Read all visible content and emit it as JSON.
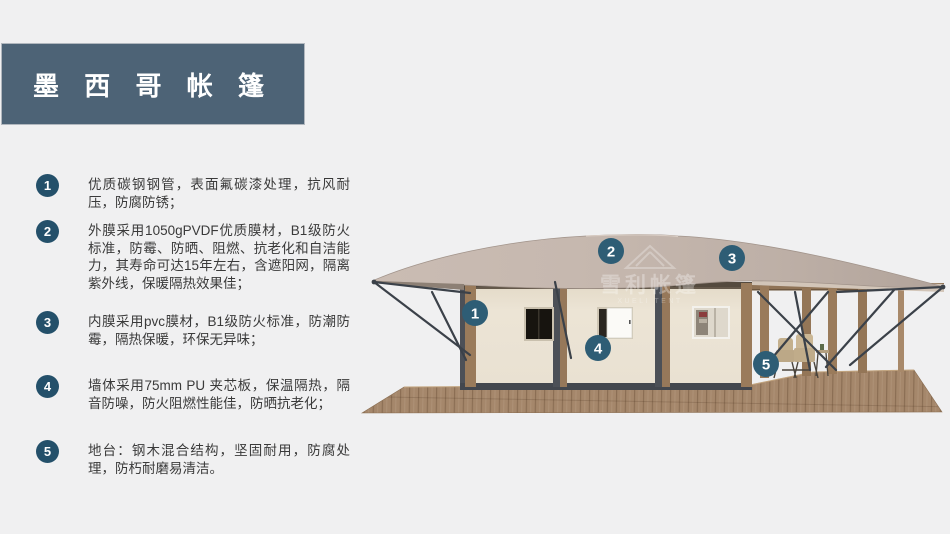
{
  "title": {
    "text": "墨 西 哥 帐 篷"
  },
  "features": [
    {
      "num": "1",
      "text": "优质碳钢钢管，表面氟碳漆处理，抗风耐压，防腐防锈；"
    },
    {
      "num": "2",
      "text": "外膜采用1050gPVDF优质膜材，B1级防火标准，防霉、防晒、阻燃、抗老化和自洁能力，其寿命可达15年左右，含遮阳网，隔离紫外线，保暖隔热效果佳；"
    },
    {
      "num": "3",
      "text": "内膜采用pvc膜材，B1级防火标准，防潮防霉，隔热保暖，环保无异味；"
    },
    {
      "num": "4",
      "text": "墙体采用75mm PU 夹芯板，保温隔热，隔音防噪，防火阻燃性能佳，防晒抗老化；"
    },
    {
      "num": "5",
      "text": "地台：钢木混合结构，坚固耐用，防腐处理，防朽耐磨易清洁。"
    }
  ],
  "tent": {
    "markers": [
      {
        "num": "1"
      },
      {
        "num": "2"
      },
      {
        "num": "3"
      },
      {
        "num": "4"
      },
      {
        "num": "5"
      }
    ],
    "watermark": {
      "line1": "雪利帐篷",
      "line2": "XUELI TENT"
    }
  },
  "colors": {
    "background": "#f0f0f1",
    "title_bg": "#4d6376",
    "badge_bg": "#24506a",
    "marker_bg": "#2e5d75",
    "roof": "#c3b5ac",
    "wall": "#ebe3d4",
    "frame": "#4c5057",
    "wood_post": "#9a7b5b",
    "deck": "#a5876b",
    "strut": "#3b4149",
    "text": "#3a3a3a"
  }
}
